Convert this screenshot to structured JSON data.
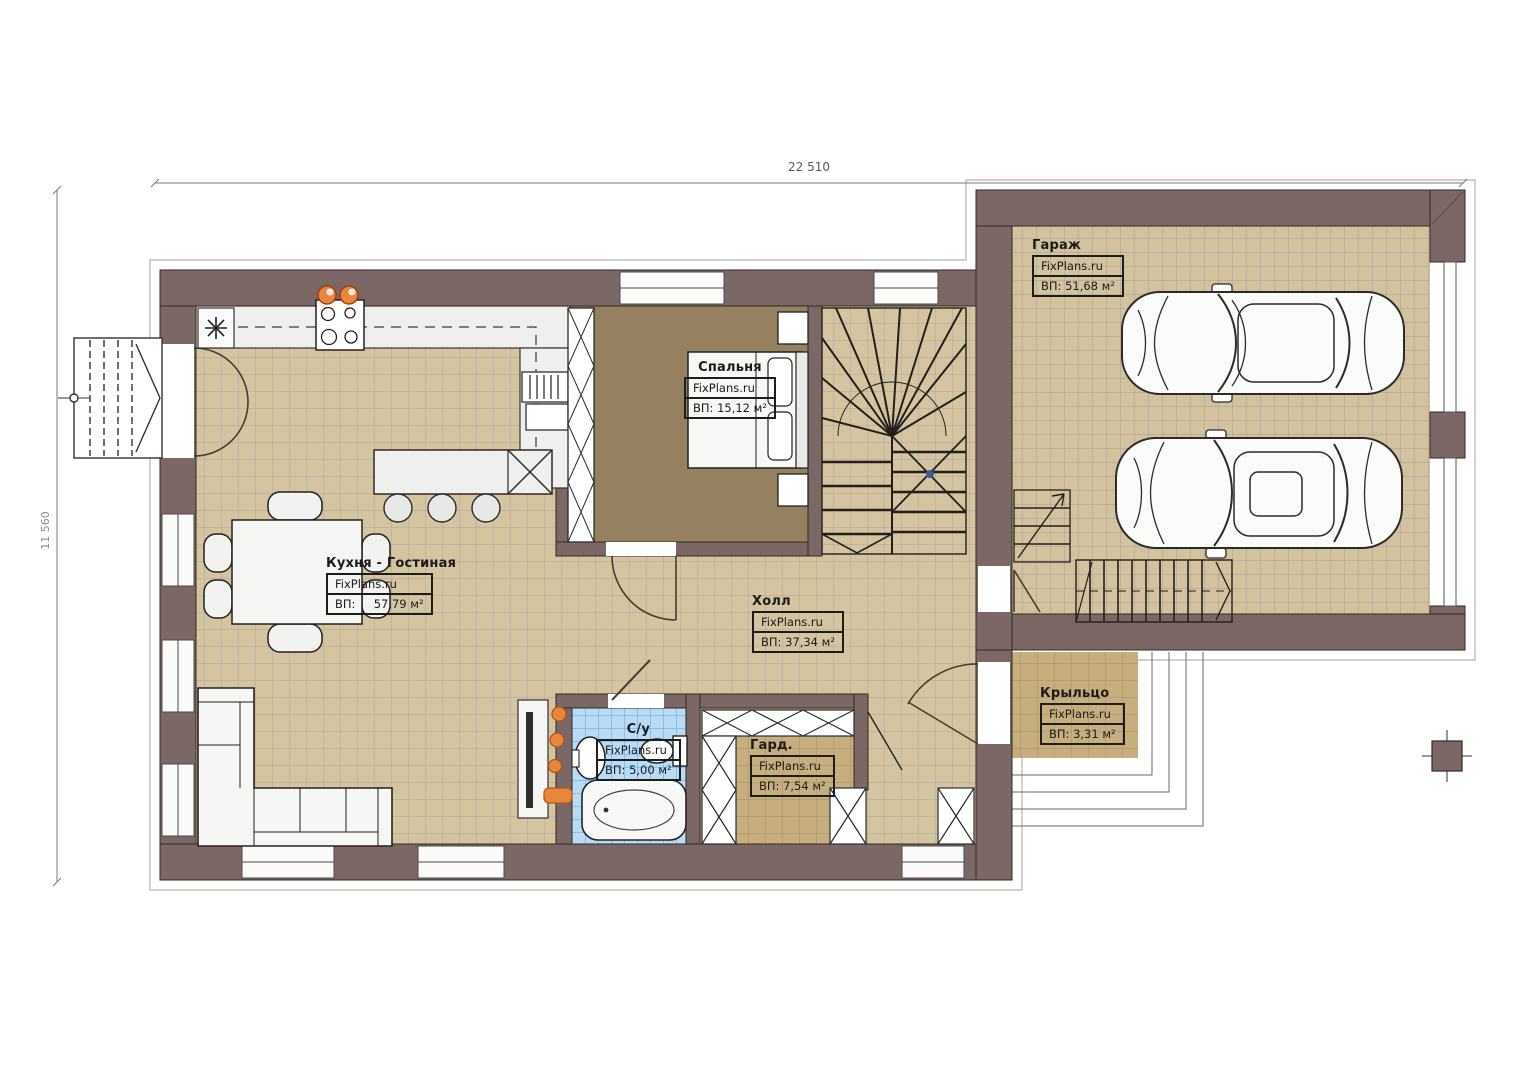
{
  "dimensions": {
    "width": "22 510",
    "height": "11 560"
  },
  "rooms": {
    "garage": {
      "name": "Гараж",
      "brand": "FixPlans.ru",
      "area": "ВП: 51,68 м²"
    },
    "bedroom": {
      "name": "Спальня",
      "brand": "FixPlans.ru",
      "area": "ВП: 15,12 м²"
    },
    "kitchen": {
      "name": "Кухня - Гостиная",
      "brand": "FixPlans.ru",
      "area": "ВП:     57,79 м²"
    },
    "hall": {
      "name": "Холл",
      "brand": "FixPlans.ru",
      "area": "ВП: 37,34 м²"
    },
    "bathroom": {
      "name": "С/у",
      "brand": "FixPlans.ru",
      "area": "ВП: 5,00 м²"
    },
    "wardrobe": {
      "name": "Гард.",
      "brand": "FixPlans.ru",
      "area": "ВП: 7,54 м²"
    },
    "porch": {
      "name": "Крыльцо",
      "brand": "FixPlans.ru",
      "area": "ВП: 3,31 м²"
    }
  },
  "colors": {
    "wall": "#7b6866",
    "floor_beige": "#d5c4a0",
    "floor_tan": "#c6ae7e",
    "floor_blue": "#b9dbf6",
    "floor_bedroom": "#95815f",
    "accent_orange": "#e8873c"
  }
}
